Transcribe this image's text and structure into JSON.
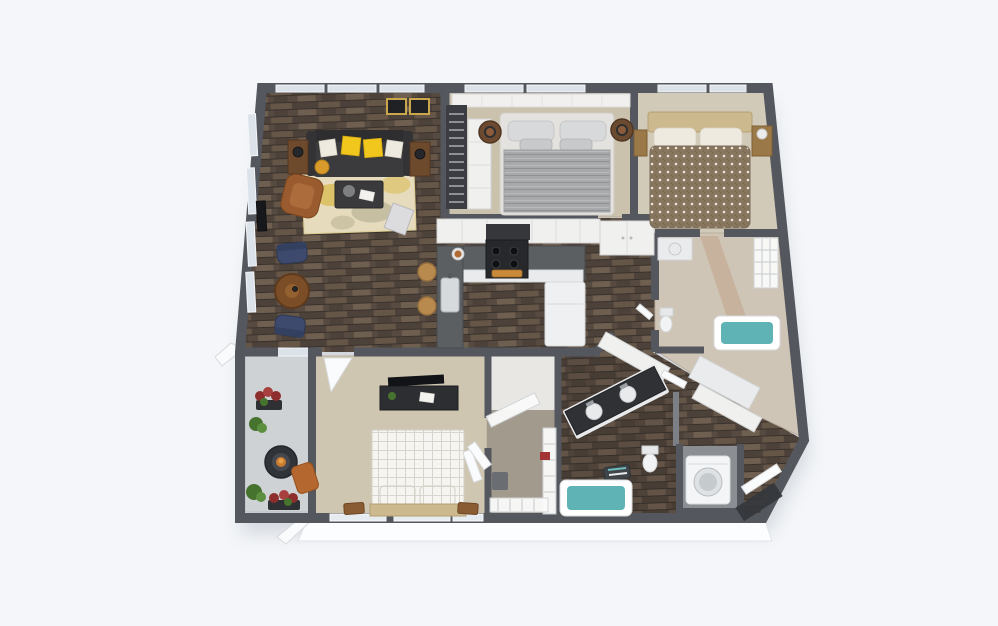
{
  "scene": {
    "description": "3D dollhouse-style rendered floor plan of a two-bedroom-plus-den apartment viewed from above on a light blue-grey background. Top row: living room with charcoal sofa, yellow pillows, gold rug, brown armchair and navy reading chairs; a bedroom with a grey striped bed; a bedroom with a brown diamond-pattern duvet. Middle: U-shaped kitchen with dark counters, stove, sink, bar stools and fridge; hallway; bathroom with teal tub and wire closet shelving. Bottom row: balcony with plants and fire table; bedroom with white checkered bed and TV console; walk-in closet with wire shelves; bathroom with angled dark double vanity, toilet and teal tub; laundry closet with washer; entry with open front door.",
    "rooms": [
      {
        "name": "living-room",
        "furniture": [
          "sofa",
          "yellow-pillows",
          "end-tables",
          "armchair",
          "coffee-table",
          "area-rug",
          "navy-chairs",
          "round-side-table",
          "wall-tv",
          "framed-art",
          "windows"
        ]
      },
      {
        "name": "bedroom-top-middle",
        "furniture": [
          "queen-bed-grey-striped",
          "barrel-nightstands",
          "ladder-shelf",
          "open-shelving",
          "panel-headboard-wall"
        ]
      },
      {
        "name": "bedroom-top-right",
        "furniture": [
          "bed-brown-diamond-duvet",
          "tan-headboard",
          "nightstands",
          "lamp"
        ]
      },
      {
        "name": "kitchen",
        "furniture": [
          "u-shaped-counter",
          "stove",
          "range-hood",
          "sink",
          "refrigerator",
          "bar-stools",
          "plate"
        ]
      },
      {
        "name": "hallway",
        "furniture": [
          "double-door-closet"
        ]
      },
      {
        "name": "bathroom-upper",
        "furniture": [
          "teal-tub",
          "vanity-sink",
          "toilet",
          "wire-shelf",
          "tan-accent-wall"
        ]
      },
      {
        "name": "balcony",
        "furniture": [
          "fire-table",
          "terracotta-chair",
          "potted-plants",
          "flower-planters",
          "sliding-door"
        ]
      },
      {
        "name": "bedroom-bottom",
        "furniture": [
          "bed-white-checkered",
          "tv-console",
          "flat-tv",
          "benches",
          "closet-doors"
        ]
      },
      {
        "name": "walk-in-closet",
        "furniture": [
          "wire-shelving",
          "hamper"
        ]
      },
      {
        "name": "bathroom-lower",
        "furniture": [
          "double-vanity-dark",
          "toilet",
          "teal-tub",
          "towel-basket"
        ]
      },
      {
        "name": "laundry-closet",
        "furniture": [
          "front-load-washer"
        ]
      },
      {
        "name": "entry",
        "furniture": [
          "front-door-open",
          "door-mat"
        ]
      }
    ]
  },
  "palette": {
    "bg": "#f4f6f9",
    "wallExt": "#54575d",
    "wallInt": "#7c7f85",
    "wallLight": "#f0f0ee",
    "windowPane": "#dce2e9",
    "wood1": "#574a40",
    "wood2": "#4d423a",
    "wood3": "#665648",
    "wood4": "#6f5f50",
    "woodLine": "#39322c",
    "carpetBed1": "#cbc2ae",
    "carpetBed2": "#d2cab8",
    "carpetBed3": "#cfc6b2",
    "bathFloor": "#cfc5b6",
    "closetFloor": "#a39a8e",
    "concrete": "#ced2d4",
    "rugGold": "#d8b94e",
    "rugCream": "#e6dcbd",
    "sofa": "#3b3b3d",
    "pillowYellow": "#f2c71d",
    "pillowWhite": "#efeae0",
    "armchair": "#9a5b2e",
    "accentNavy": "#3d4a6e",
    "frameGold": "#caa64c",
    "counter": "#5b5f62",
    "headboardTan": "#cdb98e",
    "tubTeal": "#5fb3b5",
    "plantGreen": "#46742f",
    "flowerRed": "#8d2d2d",
    "terracotta": "#b4672f"
  }
}
